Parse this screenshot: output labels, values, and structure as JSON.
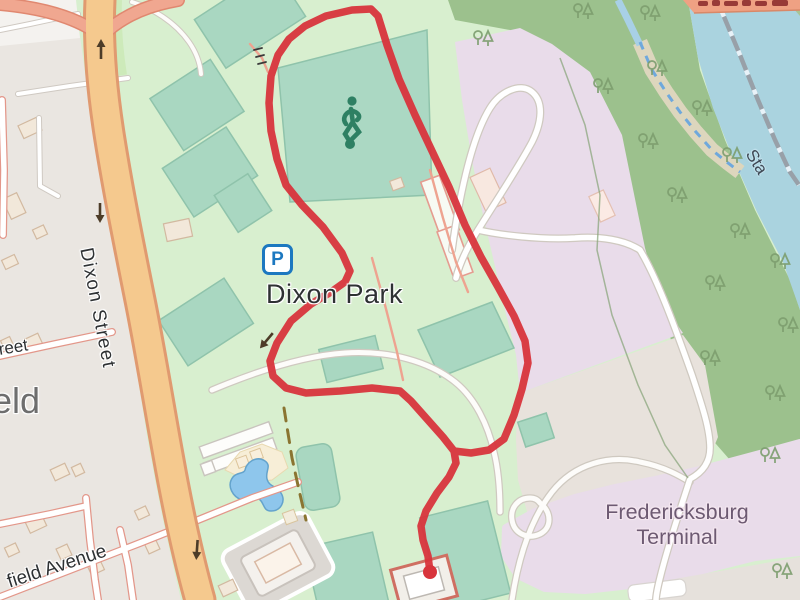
{
  "map": {
    "labels": {
      "park_name": "Dixon Park",
      "street_name": "Dixon Street",
      "terminal_line1": "Fredericksburg",
      "terminal_line2": "Terminal",
      "avenue_fragment": "field Avenue",
      "street_fragment": "treet",
      "place_fragment": "eld",
      "river_road_fragment": "Sta",
      "parking_letter": "P"
    },
    "colors": {
      "route": "#d8343c",
      "water": "#aad3df",
      "forest": "#9cc18d",
      "park_green": "#d8efcf",
      "pitch_green": "#a9d7c1",
      "primary_road": "#f5c98e",
      "ramp_road": "#f0a790",
      "railway_area": "#e9dcea",
      "residential_area": "#eae6e1",
      "building": "#f2e8da",
      "parking_blue": "#1c78c0",
      "soccer_icon_green": "#2e8063"
    },
    "route": {
      "points": [
        [
          430,
          572
        ],
        [
          428,
          556
        ],
        [
          423,
          540
        ],
        [
          421,
          526
        ],
        [
          426,
          511
        ],
        [
          437,
          493
        ],
        [
          449,
          477
        ],
        [
          456,
          463
        ],
        [
          454,
          451
        ],
        [
          443,
          437
        ],
        [
          427,
          419
        ],
        [
          411,
          401
        ],
        [
          400,
          391
        ],
        [
          372,
          388
        ],
        [
          340,
          391
        ],
        [
          306,
          393
        ],
        [
          286,
          388
        ],
        [
          273,
          376
        ],
        [
          270,
          361
        ],
        [
          277,
          343
        ],
        [
          291,
          321
        ],
        [
          311,
          304
        ],
        [
          331,
          292
        ],
        [
          345,
          282
        ],
        [
          350,
          271
        ],
        [
          342,
          253
        ],
        [
          323,
          227
        ],
        [
          302,
          205
        ],
        [
          286,
          185
        ],
        [
          277,
          159
        ],
        [
          271,
          131
        ],
        [
          269,
          103
        ],
        [
          271,
          76
        ],
        [
          278,
          55
        ],
        [
          289,
          39
        ],
        [
          305,
          26
        ],
        [
          326,
          16
        ],
        [
          352,
          10
        ],
        [
          371,
          9
        ],
        [
          378,
          16
        ],
        [
          387,
          45
        ],
        [
          399,
          79
        ],
        [
          415,
          115
        ],
        [
          432,
          151
        ],
        [
          449,
          187
        ],
        [
          465,
          225
        ],
        [
          481,
          257
        ],
        [
          498,
          287
        ],
        [
          514,
          316
        ],
        [
          525,
          341
        ],
        [
          528,
          363
        ],
        [
          522,
          389
        ],
        [
          514,
          415
        ],
        [
          504,
          439
        ],
        [
          489,
          450
        ],
        [
          471,
          453
        ],
        [
          454,
          451
        ]
      ],
      "end_marker": [
        430,
        572
      ]
    },
    "trees": [
      [
        578,
        8
      ],
      [
        645,
        10
      ],
      [
        478,
        35
      ],
      [
        652,
        65
      ],
      [
        598,
        83
      ],
      [
        697,
        105
      ],
      [
        643,
        138
      ],
      [
        727,
        152
      ],
      [
        672,
        192
      ],
      [
        735,
        228
      ],
      [
        775,
        258
      ],
      [
        710,
        280
      ],
      [
        783,
        322
      ],
      [
        705,
        355
      ],
      [
        770,
        390
      ],
      [
        765,
        452
      ],
      [
        777,
        568
      ]
    ],
    "oneway_arrows": [
      {
        "x": 101,
        "y": 50,
        "angle": 180
      },
      {
        "x": 100,
        "y": 212,
        "angle": 0
      },
      {
        "x": 197,
        "y": 549,
        "angle": 4
      },
      {
        "x": 267,
        "y": 340,
        "angle": 40
      }
    ]
  }
}
